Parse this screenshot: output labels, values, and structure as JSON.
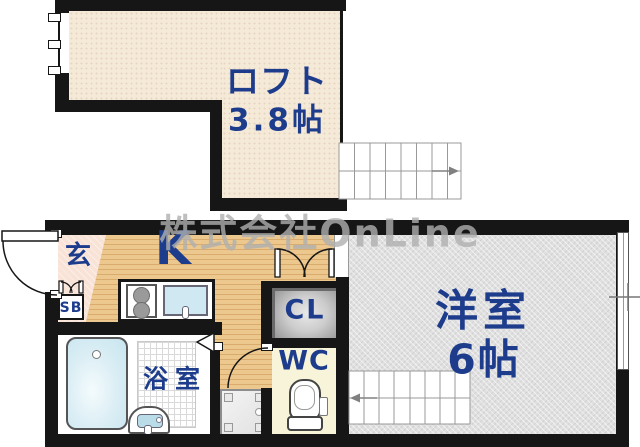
{
  "watermark": "株式会社OnLine",
  "rooms": {
    "loft": {
      "name": "ロフト",
      "size": "3.8帖"
    },
    "entrance": {
      "name": "玄"
    },
    "shoe_box": {
      "name": "SB"
    },
    "kitchen": {
      "name": "K"
    },
    "bathroom": {
      "name": "浴室"
    },
    "closet": {
      "name": "CL"
    },
    "toilet": {
      "name": "WC"
    },
    "western_room": {
      "name": "洋室",
      "size": "6帖"
    }
  },
  "colors": {
    "wall": "#161616",
    "ink": "#1d3c8c",
    "loft_floor": "#f5e9d8",
    "kitchen_floor": "#ecc88f",
    "kitchen_stripe": "#d9ac6e",
    "genkan_floor": "#f8e3d6",
    "western_floor": "#e0e0e0",
    "wc_floor": "#f8f4d9",
    "water": "#cfe8f2",
    "watermark_color": "rgba(175,175,175,0.8)"
  }
}
